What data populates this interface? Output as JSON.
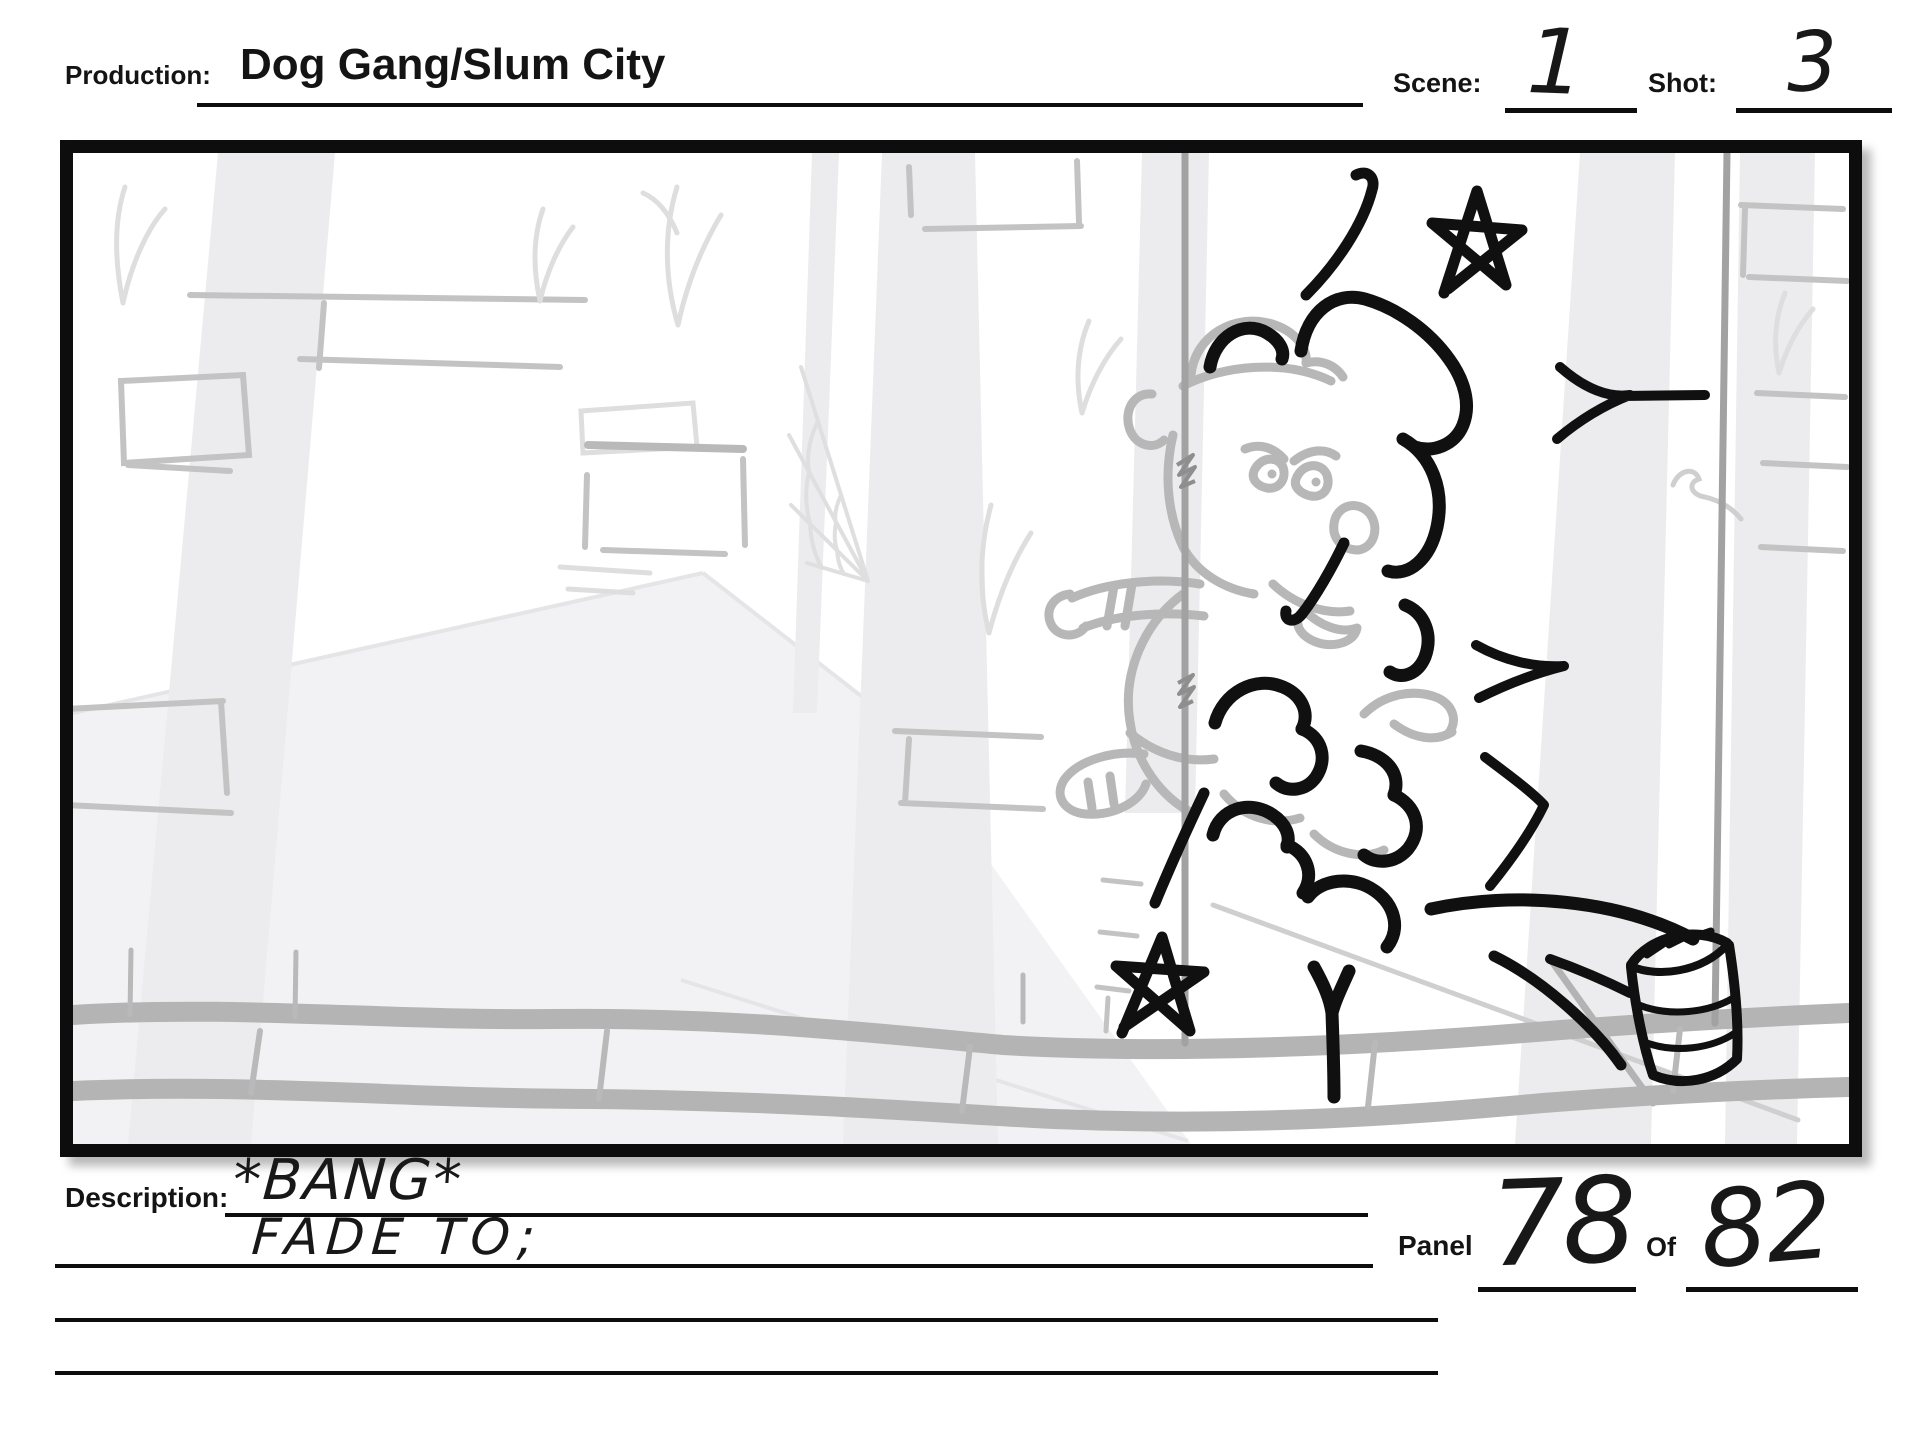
{
  "header": {
    "production_label": "Production:",
    "production_value": "Dog Gang/Slum City",
    "scene_label": "Scene:",
    "scene_value": "1",
    "shot_label": "Shot:",
    "shot_value": "3"
  },
  "storyboard_panel": {
    "sketch_elements": [
      "smoke-cloud",
      "action-star-top",
      "action-star-bottom",
      "thrown-can",
      "speed-lines",
      "impact-dashes",
      "dog-character-sketch",
      "fence-posts",
      "fence-wire",
      "brick-wall",
      "street-curb",
      "spider-web",
      "grass-tufts"
    ]
  },
  "description": {
    "label": "Description:",
    "line1": "*BANG*",
    "line2": "FADE TO;"
  },
  "panel_info": {
    "panel_label": "Panel",
    "panel_value": "78",
    "of_label": "Of",
    "of_value": "82"
  },
  "colors": {
    "ink": "#101010",
    "character_sketch": "#b7b7b7",
    "background_sketch": "#ececee",
    "curb_gray": "#b4b4b4"
  }
}
